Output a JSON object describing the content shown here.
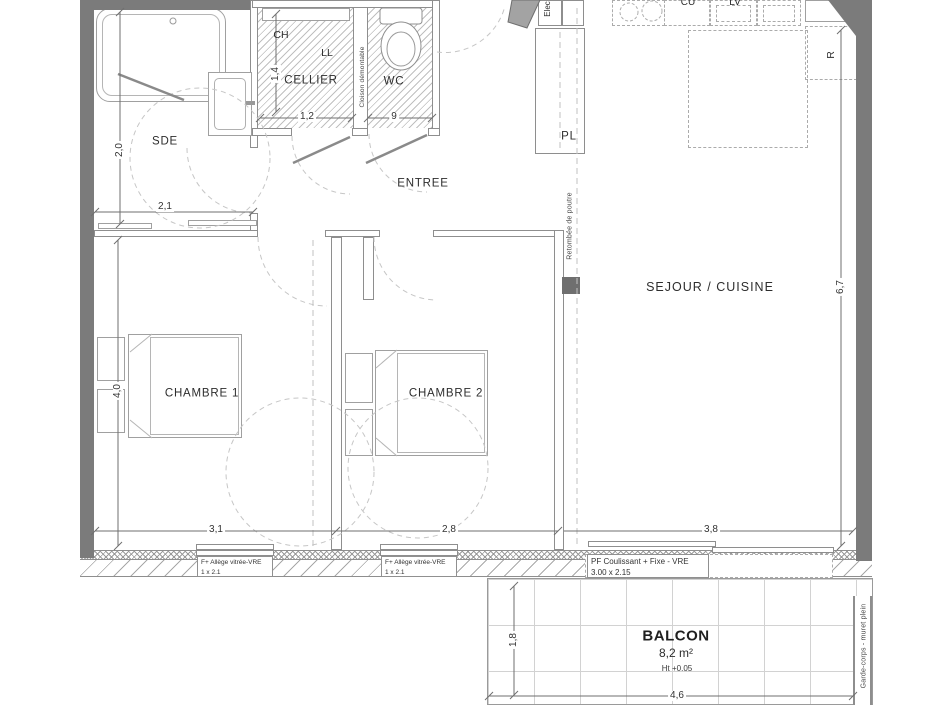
{
  "plan": {
    "rooms": {
      "sde": "SDE",
      "cellier": "CELLIER",
      "wc": "WC",
      "entree": "ENTREE",
      "pl": "PL",
      "sejour": "SEJOUR / CUISINE",
      "chambre1": "CHAMBRE 1",
      "chambre2": "CHAMBRE 2",
      "balcon": "BALCON"
    },
    "balcon_info": {
      "area": "8,2 m²",
      "height": "Ht +0.05"
    },
    "appliances": {
      "ch": "CH",
      "ll": "LL",
      "elec": "Elec",
      "cu": "CU",
      "lv": "LV",
      "fridge": "R"
    },
    "annotations": {
      "cloison": "Cloison démontable",
      "poutre": "Retombée de poutre",
      "garde_corps": "Garde-corps - muret plein"
    },
    "dimensions": {
      "sde_h": "2,0",
      "sde_w": "2,1",
      "cellier_h": "1,4",
      "cellier_w": "1,2",
      "wc_w": "9",
      "ch1_h": "4,0",
      "ch1_w": "3,1",
      "ch2_w": "2,8",
      "bay_w": "3,8",
      "sejour_h": "6,7",
      "balcon_d": "1,8",
      "balcon_w": "4,6"
    },
    "windows": [
      {
        "name": "F+ Allège vitrée-VRE",
        "size": "1 x 2.1"
      },
      {
        "name": "F+ Allège vitrée-VRE",
        "size": "1 x 2.1"
      },
      {
        "name": "PF Coulissant + Fixe - VRE",
        "size": "3.00 x 2.15"
      }
    ]
  }
}
